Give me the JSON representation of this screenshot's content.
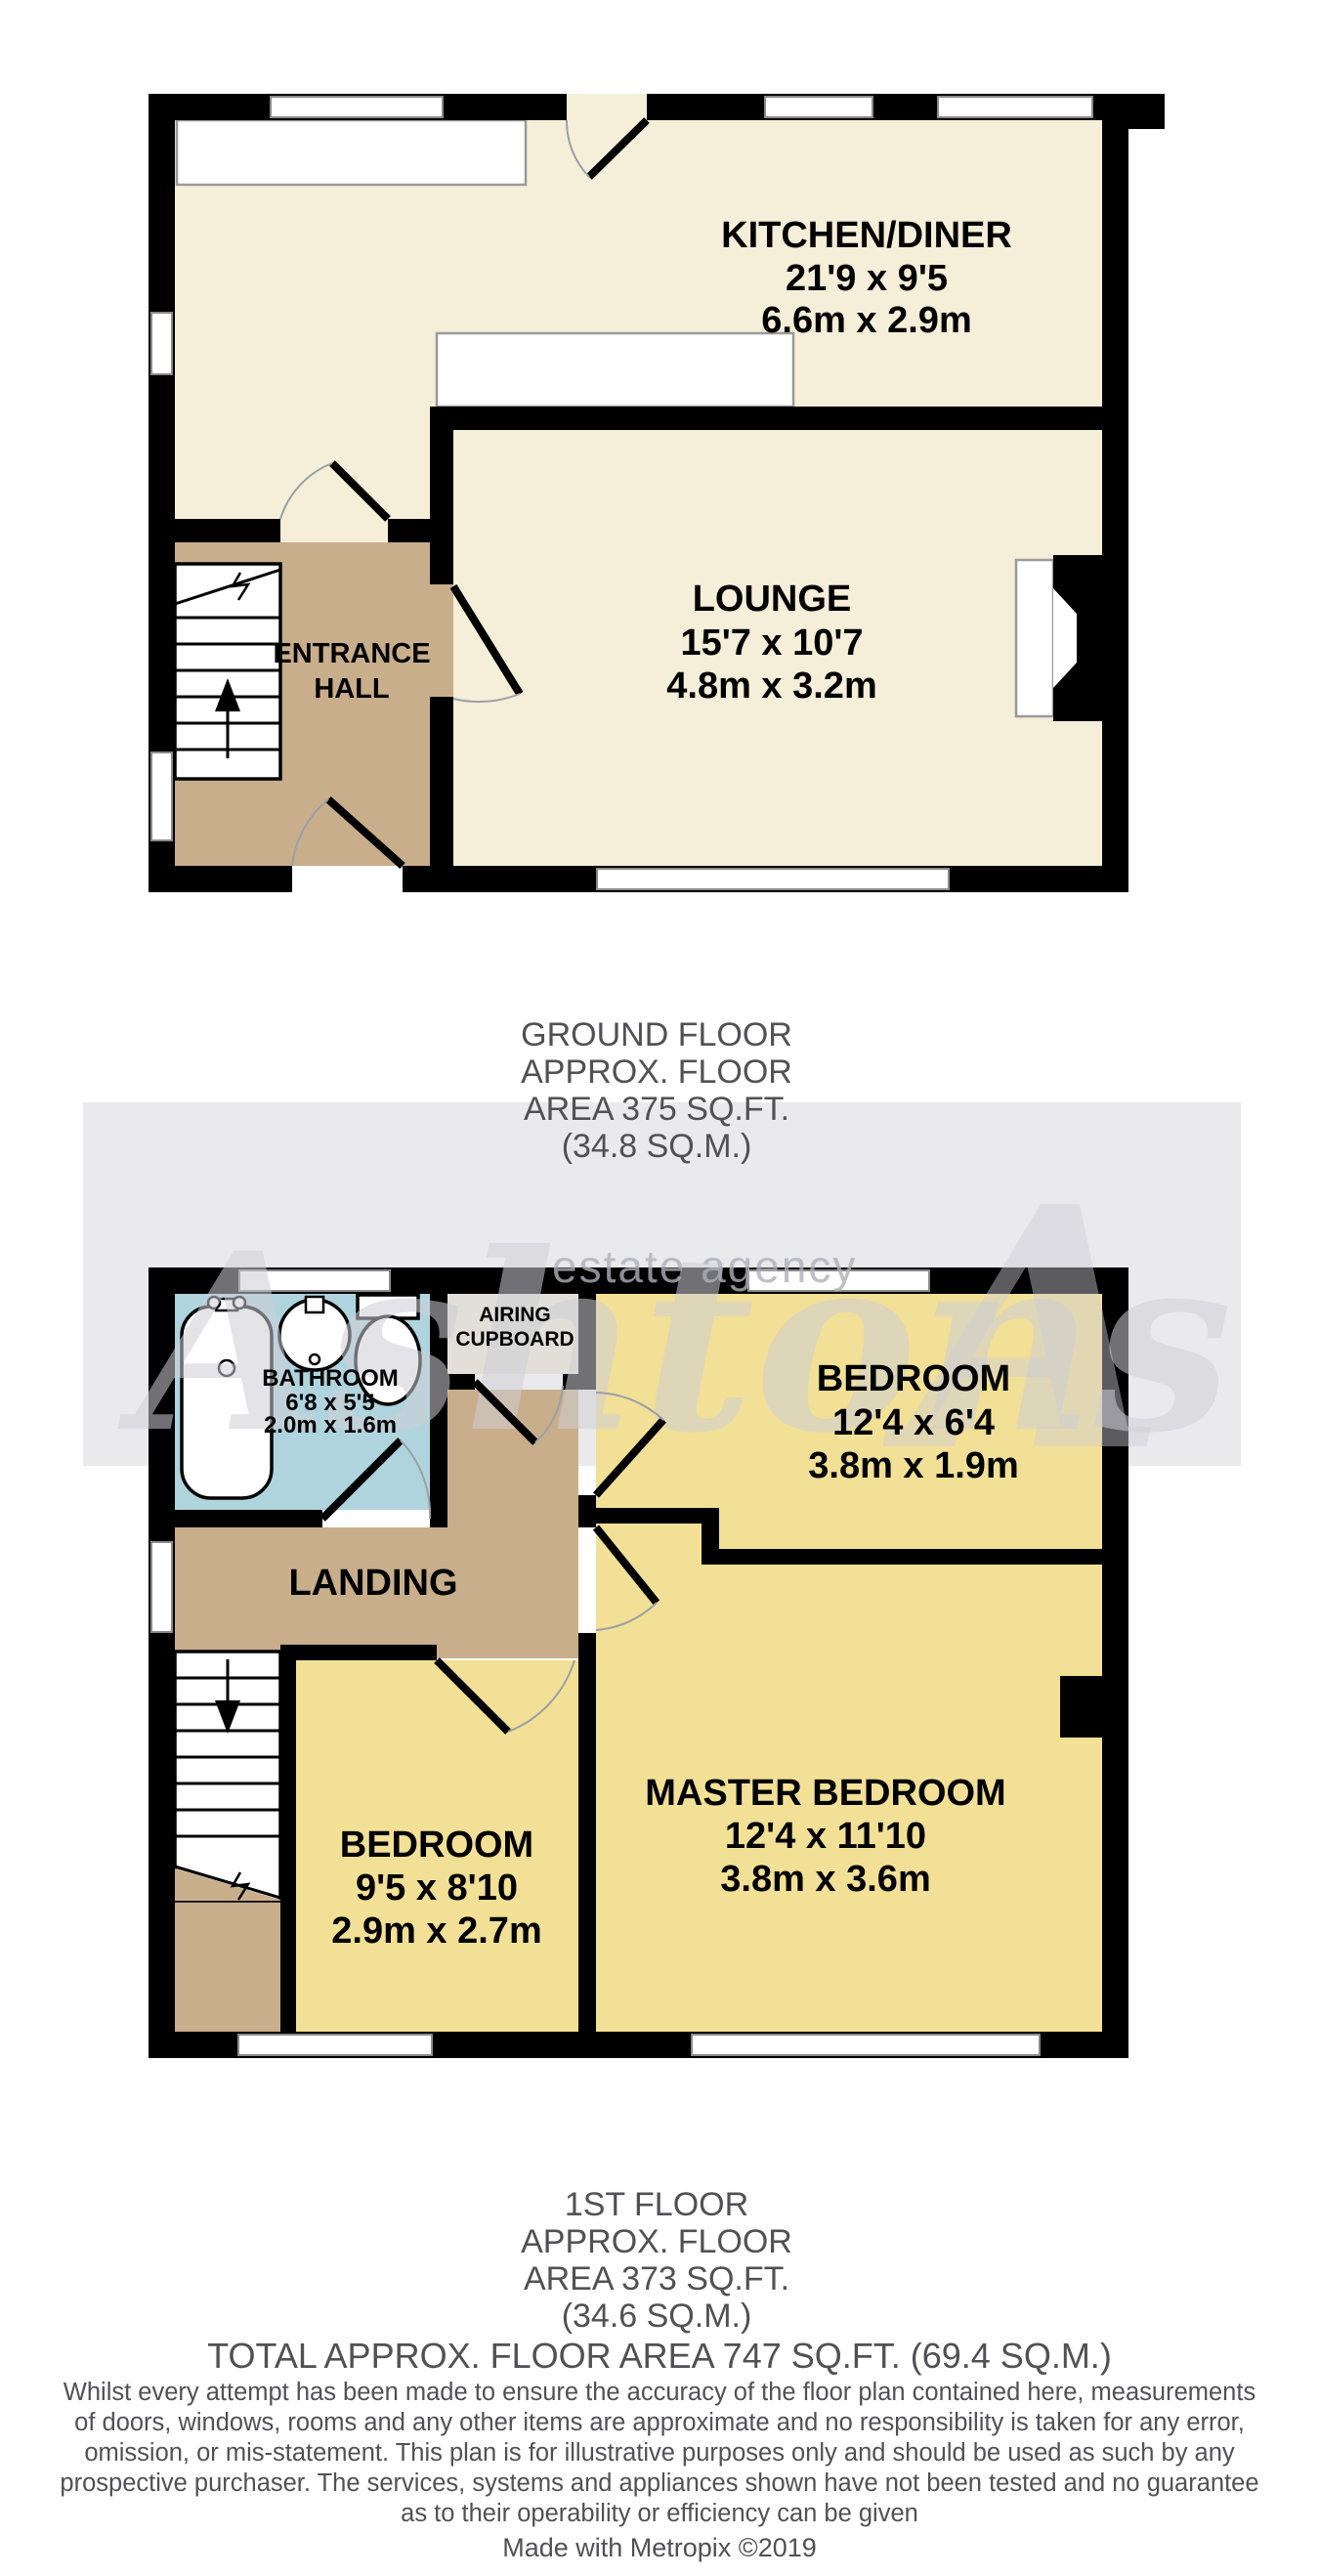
{
  "watermark": {
    "brand": "Ashtons",
    "tagline": "estate agency",
    "logo_letter": "A"
  },
  "ground_floor": {
    "title_lines": [
      "GROUND FLOOR",
      "APPROX. FLOOR",
      "AREA 375 SQ.FT.",
      "(34.8 SQ.M.)"
    ],
    "rooms": {
      "kitchen_diner": {
        "name": "KITCHEN/DINER",
        "size_imperial": "21'9 x 9'5",
        "size_metric": "6.6m x 2.9m"
      },
      "lounge": {
        "name": "LOUNGE",
        "size_imperial": "15'7 x 10'7",
        "size_metric": "4.8m x 3.2m"
      },
      "entrance_hall": {
        "name_line1": "ENTRANCE",
        "name_line2": "HALL"
      }
    }
  },
  "first_floor": {
    "title_lines": [
      "1ST FLOOR",
      "APPROX. FLOOR",
      "AREA 373 SQ.FT.",
      "(34.6 SQ.M.)"
    ],
    "rooms": {
      "bathroom": {
        "name": "BATHROOM",
        "size_imperial": "6'8 x 5'5",
        "size_metric": "2.0m x 1.6m"
      },
      "airing_cupboard": {
        "name_line1": "AIRING",
        "name_line2": "CUPBOARD"
      },
      "bedroom_front": {
        "name": "BEDROOM",
        "size_imperial": "12'4 x 6'4",
        "size_metric": "3.8m x 1.9m"
      },
      "bedroom_rear": {
        "name": "BEDROOM",
        "size_imperial": "9'5 x 8'10",
        "size_metric": "2.9m x 2.7m"
      },
      "master_bedroom": {
        "name": "MASTER BEDROOM",
        "size_imperial": "12'4 x 11'10",
        "size_metric": "3.8m x 3.6m"
      },
      "landing": {
        "name": "LANDING"
      }
    }
  },
  "total_area_label": "TOTAL APPROX. FLOOR AREA 747 SQ.FT. (69.4 SQ.M.)",
  "disclaimer_lines": [
    "Whilst every attempt has been made to ensure the accuracy of the floor plan contained here, measurements",
    "of doors, windows, rooms and any other items are approximate and no responsibility is taken for any error,",
    "omission, or mis-statement. This plan is for illustrative purposes only and should be used as such by any",
    "prospective purchaser. The services, systems and appliances shown have not been tested and no guarantee",
    "as to their operability or efficiency can be given"
  ],
  "credit": "Made with Metropix ©2019",
  "colors": {
    "room_cream": "#F5EED8",
    "room_yellow": "#F2E096",
    "hall_tan": "#C9AE8C",
    "bathroom_blue": "#AFD4DE",
    "wall_black": "#000000",
    "watermark_band": "#EAEAED",
    "floor_label_gray": "#515155"
  }
}
